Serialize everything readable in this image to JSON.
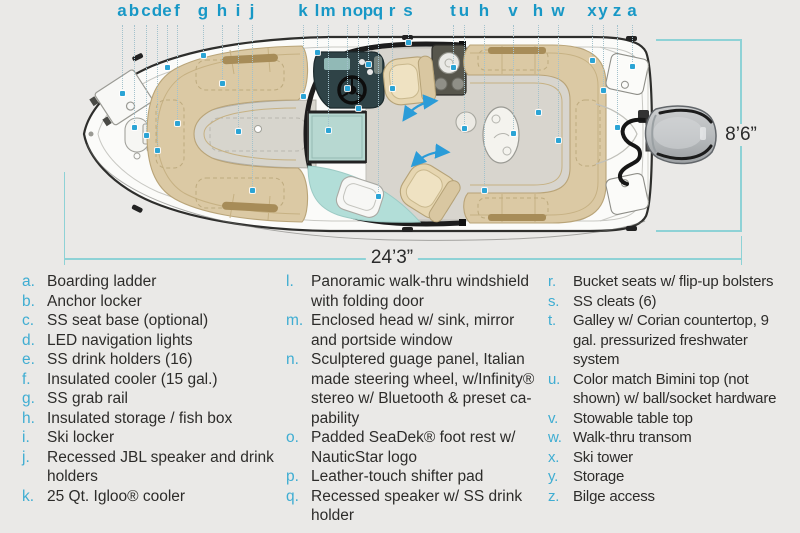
{
  "diagram": {
    "beam_label": "8’6”",
    "length_label": "24’3”",
    "colors": {
      "callout_letter": "#1898c6",
      "legend_letter": "#3fadd2",
      "body_text": "#2d2c2a",
      "dimension_line": "#8ed2d6",
      "feature_dot": "#2ba4d5",
      "walkway_arrow": "#2b9cd8",
      "upholstery_tan": "#dbc9a4",
      "glass_teal": "#b7d8d1"
    },
    "icons": {
      "feature_dot": "blue-square-marker",
      "walkway_arrows": "double-headed-curved-arrow"
    },
    "callouts": [
      {
        "letter": "a",
        "x": 122,
        "dot_y": 93
      },
      {
        "letter": "b",
        "x": 134,
        "dot_y": 127
      },
      {
        "letter": "c",
        "x": 146,
        "dot_y": 135
      },
      {
        "letter": "d",
        "x": 157,
        "dot_y": 150
      },
      {
        "letter": "e",
        "x": 167,
        "dot_y": 67
      },
      {
        "letter": "f",
        "x": 177,
        "dot_y": 123
      },
      {
        "letter": "g",
        "x": 203,
        "dot_y": 55
      },
      {
        "letter": "h",
        "x": 222,
        "dot_y": 83
      },
      {
        "letter": "i",
        "x": 238,
        "dot_y": 131
      },
      {
        "letter": "j",
        "x": 252,
        "dot_y": 190
      },
      {
        "letter": "k",
        "x": 303,
        "dot_y": 96
      },
      {
        "letter": "l",
        "x": 317,
        "dot_y": 52
      },
      {
        "letter": "m",
        "x": 328,
        "dot_y": 130
      },
      {
        "letter": "n",
        "x": 347,
        "dot_y": 88
      },
      {
        "letter": "o",
        "x": 358,
        "dot_y": 108
      },
      {
        "letter": "p",
        "x": 368,
        "dot_y": 64
      },
      {
        "letter": "q",
        "x": 378,
        "dot_y": 196
      },
      {
        "letter": "r",
        "x": 392,
        "dot_y": 88
      },
      {
        "letter": "s",
        "x": 408,
        "dot_y": 42
      },
      {
        "letter": "t",
        "x": 453,
        "dot_y": 67
      },
      {
        "letter": "u",
        "x": 464,
        "dot_y": 128
      },
      {
        "letter": "h",
        "x": 484,
        "dot_y": 190
      },
      {
        "letter": "v",
        "x": 513,
        "dot_y": 133
      },
      {
        "letter": "h",
        "x": 538,
        "dot_y": 112
      },
      {
        "letter": "w",
        "x": 558,
        "dot_y": 140
      },
      {
        "letter": "x",
        "x": 592,
        "dot_y": 60
      },
      {
        "letter": "y",
        "x": 603,
        "dot_y": 90
      },
      {
        "letter": "z",
        "x": 617,
        "dot_y": 127
      },
      {
        "letter": "a",
        "x": 632,
        "dot_y": 66
      }
    ]
  },
  "legend": {
    "columns": [
      [
        {
          "letter": "a.",
          "text": "Boarding ladder"
        },
        {
          "letter": "b.",
          "text": "Anchor locker"
        },
        {
          "letter": "c.",
          "text": "SS seat base (optional)"
        },
        {
          "letter": "d.",
          "text": "LED navigation lights"
        },
        {
          "letter": "e.",
          "text": "SS drink holders (16)"
        },
        {
          "letter": "f.",
          "text": "Insulated cooler (15 gal.)"
        },
        {
          "letter": "g.",
          "text": "SS grab rail"
        },
        {
          "letter": "h.",
          "text": "Insulated storage / fish box"
        },
        {
          "letter": "i.",
          "text": "Ski locker"
        },
        {
          "letter": "j.",
          "text": "Recessed JBL speaker and drink holders"
        },
        {
          "letter": "k.",
          "text": "25 Qt. Igloo® cooler"
        }
      ],
      [
        {
          "letter": "l.",
          "text": "Panoramic walk-thru windshield with folding door"
        },
        {
          "letter": "m.",
          "text": "Enclosed head w/ sink, mirror and portside window"
        },
        {
          "letter": "n.",
          "text": "Sculptered guage panel, Italian made steering wheel, w/Infinity® stereo w/ Bluetooth & preset ca­pability"
        },
        {
          "letter": "o.",
          "text": "Padded SeaDek® foot rest w/ NauticStar logo"
        },
        {
          "letter": "p.",
          "text": "Leather-touch shifter pad"
        },
        {
          "letter": "q.",
          "text": "Recessed speaker w/ SS drink holder"
        }
      ],
      [
        {
          "letter": "r.",
          "text": "Bucket seats w/ flip-up bolsters"
        },
        {
          "letter": "s.",
          "text": "SS cleats (6)"
        },
        {
          "letter": "t.",
          "text": "Galley w/ Corian countertop, 9 gal. pressurized freshwater system"
        },
        {
          "letter": "u.",
          "text": "Color match Bimini top (not shown) w/ ball/socket hardware"
        },
        {
          "letter": "v.",
          "text": "Stowable table top"
        },
        {
          "letter": "w.",
          "text": "Walk-thru transom"
        },
        {
          "letter": "x.",
          "text": "Ski tower"
        },
        {
          "letter": "y.",
          "text": "Storage"
        },
        {
          "letter": "z.",
          "text": "Bilge access"
        }
      ]
    ]
  }
}
